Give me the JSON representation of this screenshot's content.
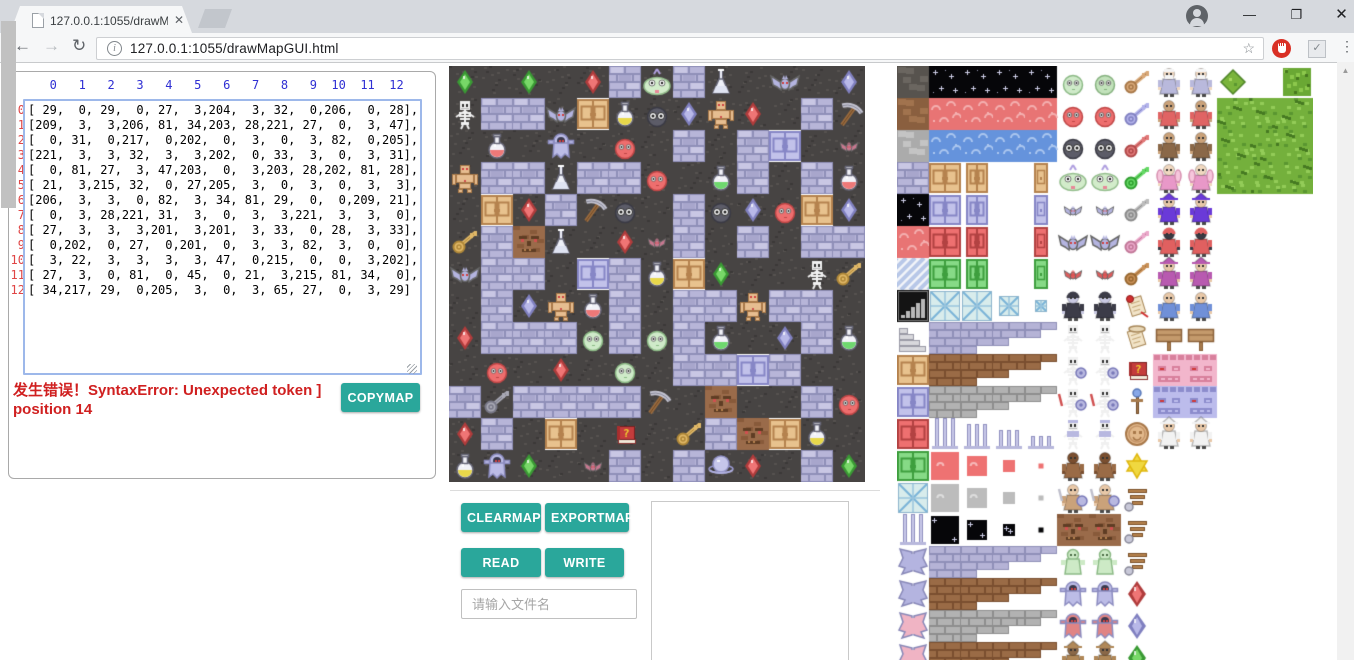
{
  "browser": {
    "tab_title": "127.0.0.1:1055/drawMa",
    "url": "127.0.0.1:1055/drawMapGUI.html"
  },
  "matrix_panel": {
    "col_header": "   0   1   2   3   4   5   6   7   8   9  10  11  12",
    "row_labels": [
      "0",
      "1",
      "2",
      "3",
      "4",
      "5",
      "6",
      "7",
      "8",
      "9",
      "10",
      "11",
      "12"
    ],
    "error_text": "发生错误！SyntaxError: Unexpected token ] position 14",
    "copymap_label": "COPYMAP"
  },
  "controls": {
    "clearmap_label": "CLEARMAP",
    "exportmap_label": "EXPORTMAP",
    "read_label": "READ",
    "write_label": "WRITE",
    "filename_placeholder": "请输入文件名"
  },
  "colors": {
    "accent_teal": "#2aa79b",
    "error_red": "#d02020",
    "header_blue": "#2f2fd3",
    "row_label_red": "#e04545",
    "ground_dark": "#474443",
    "brick_lavender": "#b7b5d8"
  },
  "map": {
    "tile_size": 32,
    "grid": [
      [
        29,
        0,
        29,
        0,
        27,
        3,
        204,
        3,
        32,
        0,
        206,
        0,
        28
      ],
      [
        209,
        3,
        3,
        206,
        81,
        34,
        203,
        28,
        221,
        27,
        0,
        3,
        47
      ],
      [
        0,
        31,
        0,
        217,
        0,
        202,
        0,
        3,
        0,
        3,
        82,
        0,
        205
      ],
      [
        221,
        3,
        3,
        32,
        3,
        3,
        202,
        0,
        33,
        3,
        0,
        3,
        31
      ],
      [
        0,
        81,
        27,
        3,
        47,
        203,
        0,
        3,
        203,
        28,
        202,
        81,
        28
      ],
      [
        21,
        3,
        215,
        32,
        0,
        27,
        205,
        3,
        0,
        3,
        0,
        3,
        3
      ],
      [
        206,
        3,
        3,
        0,
        82,
        3,
        34,
        81,
        29,
        0,
        0,
        209,
        21
      ],
      [
        0,
        3,
        28,
        221,
        31,
        3,
        0,
        3,
        3,
        221,
        3,
        3,
        0
      ],
      [
        27,
        3,
        3,
        3,
        201,
        3,
        201,
        3,
        33,
        0,
        28,
        3,
        33
      ],
      [
        0,
        202,
        0,
        27,
        0,
        201,
        0,
        3,
        3,
        82,
        3,
        0,
        0
      ],
      [
        3,
        22,
        3,
        3,
        3,
        3,
        47,
        0,
        215,
        0,
        0,
        3,
        202
      ],
      [
        27,
        3,
        0,
        81,
        0,
        45,
        0,
        21,
        3,
        215,
        81,
        34,
        0
      ],
      [
        34,
        217,
        29,
        0,
        205,
        3,
        0,
        3,
        65,
        27,
        0,
        3,
        29
      ]
    ]
  },
  "tile_defs": {
    "0": "ground",
    "3": "brickLav",
    "21": "key:#e0b868:#b08838",
    "22": "key:#a8a8b4:#787888",
    "27": "gem:#ef7575:#b03c3c",
    "28": "gem:#b8b8e8:#8080c0",
    "29": "gem:#78d868:#3a9a34",
    "31": "rflask:#ee7878",
    "32": "tflask:#dfe3f2",
    "33": "rflask:#6ed86e",
    "34": "rflask:#e8d84a",
    "45": "book",
    "47": "pickaxe",
    "65": "orb",
    "81": "door:#e8c28e:#b5824e:32",
    "82": "door:#c2c2ea:#8686c6:32",
    "201": "blob:#cfeac9:#8cba86:dark",
    "202": "blob:#ee6e6e:#c04646:dark",
    "203": "blob:#5c5c68:#3a3a44:big",
    "204": "bigpale",
    "205": "bat:#c87890:s",
    "206": "bat:#b4b4e0:b",
    "209": "skel:plain",
    "215": "stoneface",
    "217": "ghostT:#bcbce6",
    "221": "golem"
  },
  "tileset": {
    "rows": [
      [
        "cobble:#57534e:#6b6660",
        "stars",
        "stars",
        "stars",
        "stars",
        "blob:#cfeac9:#8cba86:dark",
        "blob:#c2e2bb:#86b27f:dark",
        "key:#d8a878:#a87848",
        "person:#b9b9dc:#f0d8c0:beard",
        "person:#b9b9dc:#f0d8c0:beard",
        "bushS",
        "blank",
        "bushQ"
      ],
      [
        "cobble:#8a5f3f:#a1734e",
        "cloud:#e87474:#f4b0b0",
        "cloud:#e87474:#f4b0b0",
        "cloud:#e87474:#f4b0b0",
        "cloud:#e87474:#f4b0b0",
        "blob:#ee6e6e:#c04646:dark",
        "blob:#ee6e6e:#c04646:dark",
        "key:#b2b2ea:#8282c2",
        "person:#e06464:#caa27a:none",
        "person:#e06464:#caa27a:none",
        "tree",
        "tree",
        "tree"
      ],
      [
        "cobble:#ababab:#c4c4c4",
        "cloud:#6593dc:#abc6ef",
        "cloud:#6593dc:#abc6ef",
        "cloud:#6593dc:#abc6ef",
        "cloud:#6593dc:#abc6ef",
        "blob:#5c5c68:#3a3a44:big",
        "blob:#5c5c68:#3a3a44:big",
        "key:#e07878:#b04848",
        "person:#8a6848:#caa27a:none",
        "person:#8a6848:#caa27a:none",
        "tree",
        "tree",
        "tree"
      ],
      [
        "brickLav",
        "door:#e8c28e:#b5824e:32",
        "door:#e8c28e:#b5824e:22",
        "blank",
        "door:#e8c28e:#b5824e:14",
        "bigpale",
        "bigpale",
        "key:#66d866:#2f9e2f",
        "person:#e898c8:#f0d8c0:wing",
        "person:#e898c8:#f0d8c0:wing",
        "tree",
        "tree",
        "tree"
      ],
      [
        "stars",
        "door:#c2c2ea:#8686c6:32",
        "door:#c2c2ea:#8686c6:22",
        "blank",
        "door:#c2c2ea:#8686c6:14",
        "bat:#b4b4e0:s",
        "bat:#b4b4e0:s",
        "key:#bcbcbc:#8a8a8a",
        "person:#6a3ad8:#e8c8a8:hat",
        "person:#6a3ad8:#e8c8a8:hat",
        "blank",
        "blank",
        "blank"
      ],
      [
        "cloud:#e87474:#f4b0b0",
        "door:#ee7070:#b24242:32",
        "door:#ee7070:#b24242:22",
        "blank",
        "door:#ee7070:#b24242:14",
        "bat:#b4b4e0:b",
        "bat:#b4b4e0:b",
        "key:#eaa8ca:#c27898",
        "person:#e06060:#3a3a44:hood",
        "person:#e06060:#3a3a44:hood",
        "blank",
        "blank",
        "blank"
      ],
      [
        "stripes",
        "door:#86da86:#3f9f3f:32",
        "door:#86da86:#3f9f3f:22",
        "blank",
        "door:#86da86:#3f9f3f:14",
        "bat:#e05c5c:s",
        "bat:#e05c5c:s",
        "key:#c89058:#986830",
        "person:#b85ab0:#e8c8a8:hat",
        "person:#b85ab0:#e8c8a8:hat",
        "blank",
        "blank",
        "blank"
      ],
      [
        "grill",
        "lattice:30",
        "lattice:30",
        "lattice:20",
        "lattice:12",
        "person:#3c3c48:#c9c9e2:hood",
        "person:#3c3c48:#c9c9e2:hood",
        "scroll:R",
        "person:#7090d8:#e8c8a8:none",
        "person:#7090d8:#e8c8a8:none",
        "blank",
        "blank",
        "blank"
      ],
      [
        "stairs",
        "bstep:#b5b3d6:#8f8fb8:1",
        "bstep:#b5b3d6:#8f8fb8:2",
        "bstep:#b5b3d6:#8f8fb8:3",
        "bstep:#b5b3d6:#8f8fb8:4",
        "skel:plain",
        "skel:plain",
        "scroll:T",
        "sign",
        "sign",
        "blank",
        "blank",
        "blank"
      ],
      [
        "door:#e8c28e:#b5824e:32",
        "bstep:#9a6b46:#7a4f30:1",
        "bstep:#9a6b46:#7a4f30:2",
        "bstep:#9a6b46:#7a4f30:3",
        "bstep:#9a6b46:#7a4f30:4",
        "skel:shield",
        "skel:shield",
        "book",
        "wallface:#f2b6cc:#d8809c",
        "wallface:#f2b6cc:#d8809c",
        "blank",
        "blank",
        "blank"
      ],
      [
        "door:#c2c2ea:#8686c6:32",
        "bstep:#b2b2b2:#8e8e8e:1",
        "bstep:#b2b2b2:#8e8e8e:2",
        "bstep:#b2b2b2:#8e8e8e:3",
        "bstep:#b2b2b2:#8e8e8e:4",
        "skel:sword",
        "skel:sword",
        "staff",
        "wallface:#bcbcec:#8c8ccc",
        "wallface:#bcbcec:#8c8ccc",
        "blank",
        "blank",
        "blank"
      ],
      [
        "door:#ee7070:#b24242:32",
        "pillar:1",
        "pillar:2",
        "pillar:3",
        "pillar:4",
        "skel:armor",
        "skel:armor",
        "coin",
        "person:#f2f2f2:#e8c8a8:hat",
        "person:#f2f2f2:#e8c8a8:hat",
        "blank",
        "blank",
        "blank"
      ],
      [
        "door:#86da86:#3f9f3f:32",
        "sqtile:#ee7272:28",
        "sqtile:#ee7272:20",
        "sqtile:#ee7272:12",
        "sqtile:#ee7272:5",
        "person:#9a6b46:#7a4f30:none",
        "person:#9a6b46:#7a4f30:none",
        "starD",
        "blank",
        "blank",
        "blank",
        "blank",
        "blank"
      ],
      [
        "lattice:30",
        "sqtile:#bcbcbc:28",
        "sqtile:#bcbcbc:20",
        "sqtile:#bcbcbc:12",
        "sqtile:#bcbcbc:5",
        "mummy",
        "mummy",
        "wingE",
        "blank",
        "blank",
        "blank",
        "blank",
        "blank"
      ],
      [
        "pillar:1",
        "sqstar:28",
        "sqstar:20",
        "sqstar:12",
        "sqstar:5",
        "stoneface",
        "stoneface",
        "wingE",
        "blank",
        "blank",
        "blank",
        "blank",
        "blank"
      ],
      [
        "wings:#b4b4e0",
        "bstep:#b5b3d6:#8f8fb8:1",
        "bstep:#b5b3d6:#8f8fb8:2",
        "bstep:#b5b3d6:#8f8fb8:3",
        "bstep:#b5b3d6:#8f8fb8:4",
        "slime",
        "slime",
        "wingE",
        "blank",
        "blank",
        "blank",
        "blank",
        "blank"
      ],
      [
        "wings:#b4b4e0",
        "bstep:#9a6b46:#7a4f30:1",
        "bstep:#9a6b46:#7a4f30:2",
        "bstep:#9a6b46:#7a4f30:3",
        "bstep:#9a6b46:#7a4f30:4",
        "ghostT:#bcbce6",
        "ghostT:#bcbce6",
        "gemB:#ef7575:#b03c3c",
        "blank",
        "blank",
        "blank",
        "blank",
        "blank"
      ],
      [
        "wings:#f0b4c4",
        "bstep:#b2b2b2:#8e8e8e:1",
        "bstep:#b2b2b2:#8e8e8e:2",
        "bstep:#b2b2b2:#8e8e8e:3",
        "bstep:#b2b2b2:#8e8e8e:4",
        "ghostT:#e08484",
        "ghostT:#e08484",
        "gemB:#b8b8e8:#8080c0",
        "blank",
        "blank",
        "blank",
        "blank",
        "blank"
      ],
      [
        "wings:#f0b4c4",
        "bstep:#9a6b46:#7a4f30:1",
        "bstep:#9a6b46:#7a4f30:2",
        "bstep:#9a6b46:#7a4f30:3",
        "bstep:#9a6b46:#7a4f30:4",
        "person:#b08858:#8a6848:hat",
        "person:#b08858:#8a6848:hat",
        "gemB:#78d868:#3a9a34",
        "blank",
        "blank",
        "blank",
        "blank",
        "blank"
      ]
    ]
  }
}
